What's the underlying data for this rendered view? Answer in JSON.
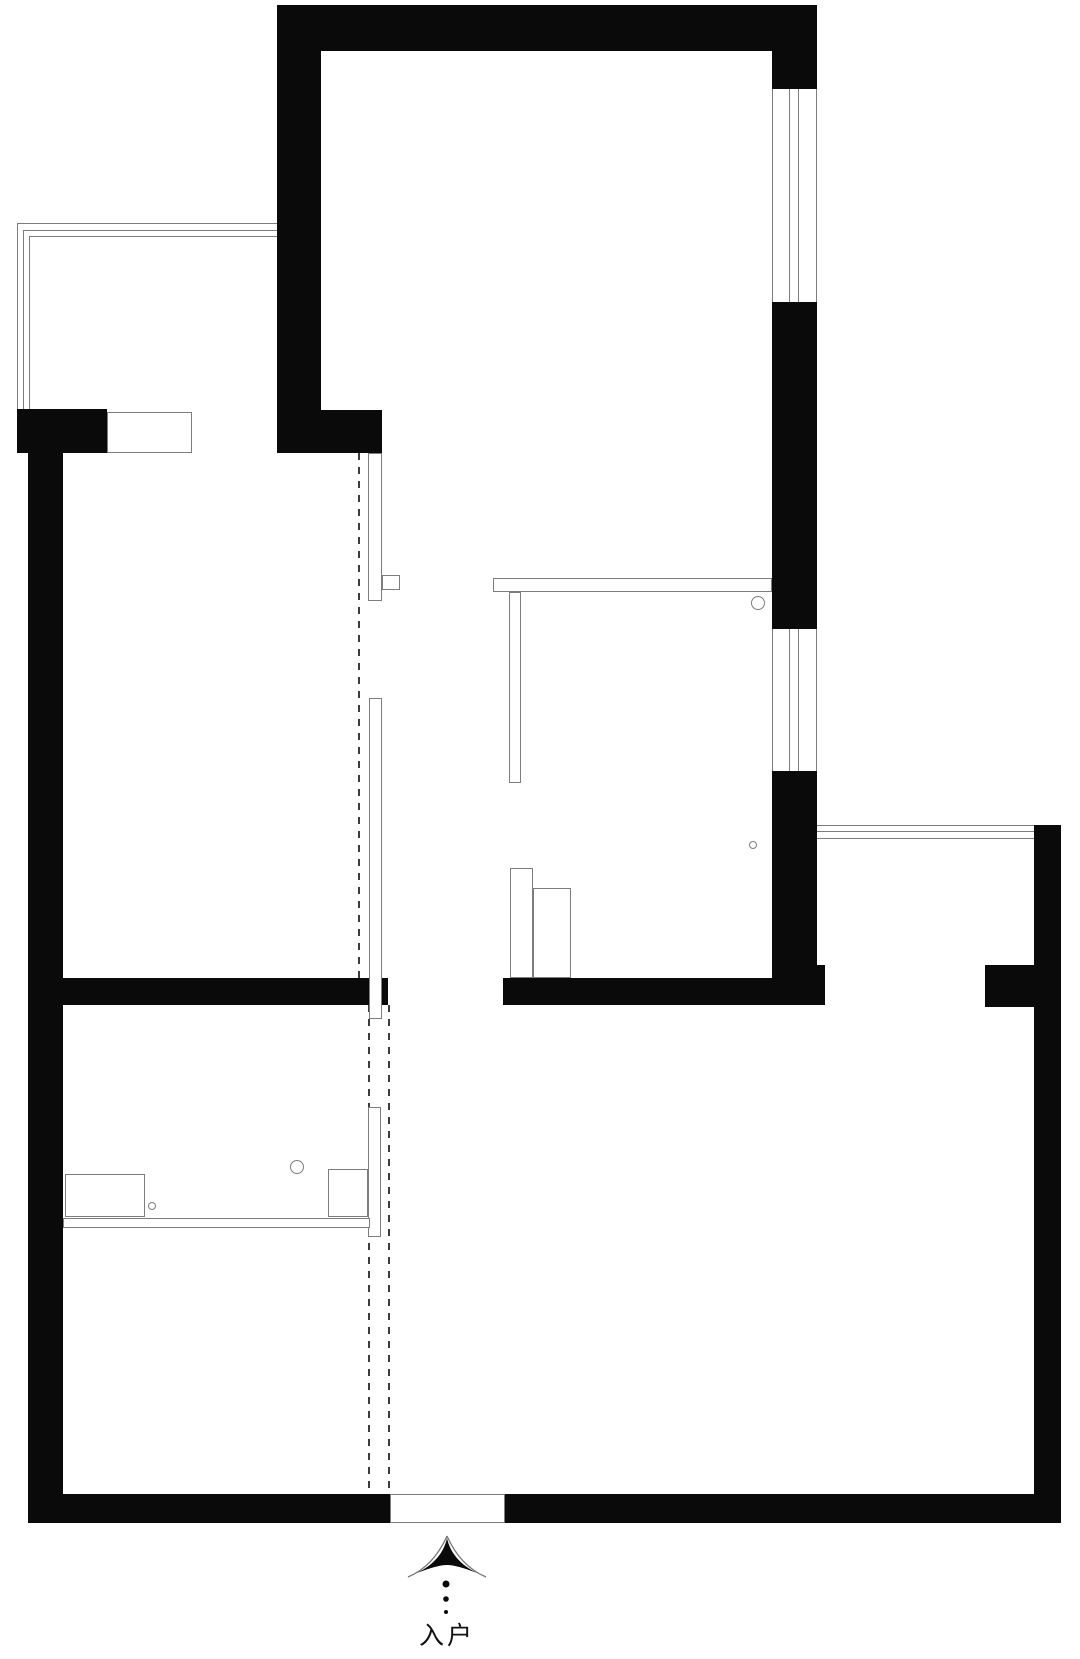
{
  "plan": {
    "entrance_label": "入户",
    "canvas": {
      "width": 1080,
      "height": 1659
    },
    "colors": {
      "wall": "#0a0a0a",
      "outline": "#7d7d7d",
      "dash": "#3c3c3c",
      "background": "#ffffff"
    },
    "elements": [
      {
        "name": "top-wall",
        "kind": "wall",
        "x": 277,
        "y": 5,
        "w": 540,
        "h": 46
      },
      {
        "name": "upper-left-wall",
        "kind": "wall",
        "x": 277,
        "y": 5,
        "w": 44,
        "h": 448
      },
      {
        "name": "partition-header-wall",
        "kind": "wall",
        "x": 321,
        "y": 410,
        "w": 61,
        "h": 43
      },
      {
        "name": "balcony-corner-wall",
        "kind": "wall",
        "x": 17,
        "y": 409,
        "w": 90,
        "h": 44
      },
      {
        "name": "left-outer-wall",
        "kind": "wall",
        "x": 28,
        "y": 412,
        "w": 35,
        "h": 1111
      },
      {
        "name": "bottom-wall",
        "kind": "wall",
        "x": 28,
        "y": 1494,
        "w": 1033,
        "h": 29
      },
      {
        "name": "right-upper-wall-a",
        "kind": "wall",
        "x": 772,
        "y": 51,
        "w": 45,
        "h": 38
      },
      {
        "name": "right-upper-wall-b",
        "kind": "wall",
        "x": 772,
        "y": 302,
        "w": 45,
        "h": 327
      },
      {
        "name": "right-upper-wall-c",
        "kind": "wall",
        "x": 772,
        "y": 771,
        "w": 45,
        "h": 194
      },
      {
        "name": "right-mid-foot-wall",
        "kind": "wall",
        "x": 772,
        "y": 965,
        "w": 53,
        "h": 40
      },
      {
        "name": "mid-wall-left",
        "kind": "wall",
        "x": 63,
        "y": 978,
        "w": 325,
        "h": 27
      },
      {
        "name": "mid-wall-right",
        "kind": "wall",
        "x": 503,
        "y": 978,
        "w": 269,
        "h": 27
      },
      {
        "name": "right-stub-wall",
        "kind": "wall",
        "x": 985,
        "y": 965,
        "w": 49,
        "h": 42
      },
      {
        "name": "right-outer-wall",
        "kind": "wall",
        "x": 1034,
        "y": 825,
        "w": 27,
        "h": 698
      },
      {
        "name": "balcony-window-line-h1",
        "kind": "line",
        "x": 17,
        "y": 223,
        "w": 260,
        "h": 1
      },
      {
        "name": "balcony-window-line-h2",
        "kind": "line",
        "x": 23,
        "y": 230,
        "w": 254,
        "h": 1
      },
      {
        "name": "balcony-window-line-h3",
        "kind": "line",
        "x": 29,
        "y": 236,
        "w": 248,
        "h": 1
      },
      {
        "name": "balcony-window-line-v1",
        "kind": "line",
        "x": 17,
        "y": 223,
        "w": 1,
        "h": 186
      },
      {
        "name": "balcony-window-line-v2",
        "kind": "line",
        "x": 23,
        "y": 230,
        "w": 1,
        "h": 179
      },
      {
        "name": "balcony-window-line-v3",
        "kind": "line",
        "x": 29,
        "y": 236,
        "w": 1,
        "h": 173
      },
      {
        "name": "right-window1-line-1",
        "kind": "line",
        "x": 772,
        "y": 89,
        "w": 1,
        "h": 213
      },
      {
        "name": "right-window1-line-2",
        "kind": "line",
        "x": 789,
        "y": 89,
        "w": 1,
        "h": 213
      },
      {
        "name": "right-window1-line-3",
        "kind": "line",
        "x": 798,
        "y": 89,
        "w": 1,
        "h": 213
      },
      {
        "name": "right-window1-line-4",
        "kind": "line",
        "x": 816,
        "y": 89,
        "w": 1,
        "h": 213
      },
      {
        "name": "right-window2-line-1",
        "kind": "line",
        "x": 772,
        "y": 629,
        "w": 1,
        "h": 142
      },
      {
        "name": "right-window2-line-2",
        "kind": "line",
        "x": 789,
        "y": 629,
        "w": 1,
        "h": 142
      },
      {
        "name": "right-window2-line-3",
        "kind": "line",
        "x": 798,
        "y": 629,
        "w": 1,
        "h": 142
      },
      {
        "name": "right-window2-line-4",
        "kind": "line",
        "x": 816,
        "y": 629,
        "w": 1,
        "h": 142
      },
      {
        "name": "south-window-line-1",
        "kind": "line",
        "x": 817,
        "y": 825,
        "w": 217,
        "h": 1
      },
      {
        "name": "south-window-line-2",
        "kind": "line",
        "x": 817,
        "y": 831,
        "w": 217,
        "h": 1
      },
      {
        "name": "south-window-line-3",
        "kind": "line",
        "x": 817,
        "y": 838,
        "w": 217,
        "h": 1
      },
      {
        "name": "balcony-opening",
        "kind": "open",
        "x": 107,
        "y": 412,
        "w": 85,
        "h": 41
      },
      {
        "name": "entrance-opening",
        "kind": "open",
        "x": 390,
        "y": 1494,
        "w": 115,
        "h": 29
      },
      {
        "name": "door-track-dash-upper",
        "kind": "dash",
        "x": 358,
        "y": 453,
        "w": 2,
        "h": 525
      },
      {
        "name": "door-track-dash-lower-left",
        "kind": "dash",
        "x": 368,
        "y": 1005,
        "w": 2,
        "h": 489
      },
      {
        "name": "door-track-dash-lower-right",
        "kind": "dash",
        "x": 388,
        "y": 1005,
        "w": 2,
        "h": 489
      },
      {
        "name": "sliding-panel-upper",
        "kind": "panel",
        "x": 368,
        "y": 453,
        "w": 14,
        "h": 148
      },
      {
        "name": "sliding-panel-hook",
        "kind": "panel",
        "x": 382,
        "y": 575,
        "w": 18,
        "h": 15
      },
      {
        "name": "sliding-panel-middle",
        "kind": "panel",
        "x": 369,
        "y": 698,
        "w": 13,
        "h": 321
      },
      {
        "name": "sliding-panel-bath",
        "kind": "panel",
        "x": 368,
        "y": 1107,
        "w": 13,
        "h": 130
      },
      {
        "name": "counter-bar",
        "kind": "panel",
        "x": 493,
        "y": 578,
        "w": 279,
        "h": 14
      },
      {
        "name": "counter-leg",
        "kind": "panel",
        "x": 509,
        "y": 592,
        "w": 12,
        "h": 191
      },
      {
        "name": "cabinet-a",
        "kind": "panel",
        "x": 510,
        "y": 868,
        "w": 23,
        "h": 110
      },
      {
        "name": "cabinet-b",
        "kind": "panel",
        "x": 533,
        "y": 888,
        "w": 38,
        "h": 90
      },
      {
        "name": "bath-counter",
        "kind": "panel",
        "x": 65,
        "y": 1174,
        "w": 80,
        "h": 43
      },
      {
        "name": "bath-bench",
        "kind": "panel",
        "x": 63,
        "y": 1218,
        "w": 307,
        "h": 10
      },
      {
        "name": "bath-cabinet",
        "kind": "panel",
        "x": 328,
        "y": 1169,
        "w": 40,
        "h": 48
      },
      {
        "name": "fixture-circle-1",
        "kind": "circle",
        "x": 751,
        "y": 596,
        "w": 14,
        "h": 14
      },
      {
        "name": "fixture-circle-2",
        "kind": "circle",
        "x": 749,
        "y": 841,
        "w": 8,
        "h": 8
      },
      {
        "name": "fixture-circle-3",
        "kind": "circle",
        "x": 290,
        "y": 1160,
        "w": 14,
        "h": 14
      },
      {
        "name": "fixture-circle-4",
        "kind": "circle",
        "x": 148,
        "y": 1202,
        "w": 8,
        "h": 8
      }
    ]
  }
}
